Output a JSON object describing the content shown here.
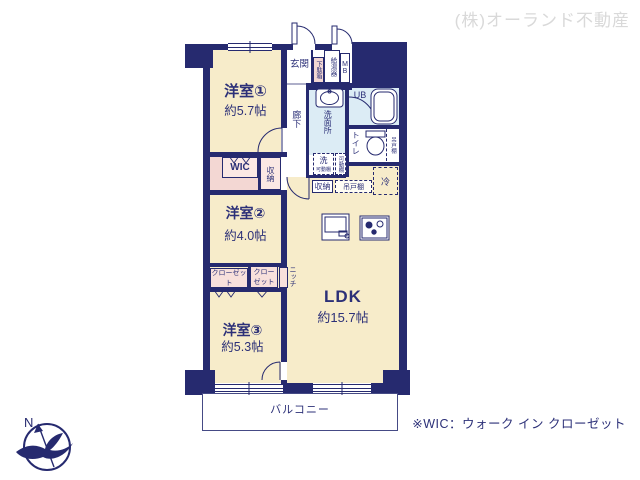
{
  "watermark": "(株)オーランド不動産",
  "footnote": "※WIC：ウォーク イン クローゼット",
  "compass_north": "N",
  "rooms": {
    "bedroom1_name": "洋室①",
    "bedroom1_size": "約5.7帖",
    "bedroom2_name": "洋室②",
    "bedroom2_size": "約4.0帖",
    "bedroom3_name": "洋室③",
    "bedroom3_size": "約5.3帖",
    "ldk_name": "LDK",
    "ldk_size": "約15.7帖",
    "entrance": "玄関",
    "hallway": "廊下",
    "washroom": "洗面所",
    "bath": "UB",
    "toilet": "トイレ",
    "balcony": "バルコニー"
  },
  "storage": {
    "wic": "WIC",
    "storage_wic_row": "収納",
    "storage_kitchen": "収納",
    "closet_long": "クローゼット",
    "closet_small": "クローゼット",
    "niche": "ニッチ",
    "shoe_box": "下駄箱",
    "hanging_shelf_toilet": "吊戸棚",
    "hanging_shelf_kitchen": "吊戸棚",
    "movable_shelf": "可動棚",
    "laundry": "洗",
    "laundry_shelf": "可動棚",
    "refrigerator": "冷"
  },
  "utilities": {
    "water_heater": "給湯器",
    "meter_box": "MB"
  }
}
